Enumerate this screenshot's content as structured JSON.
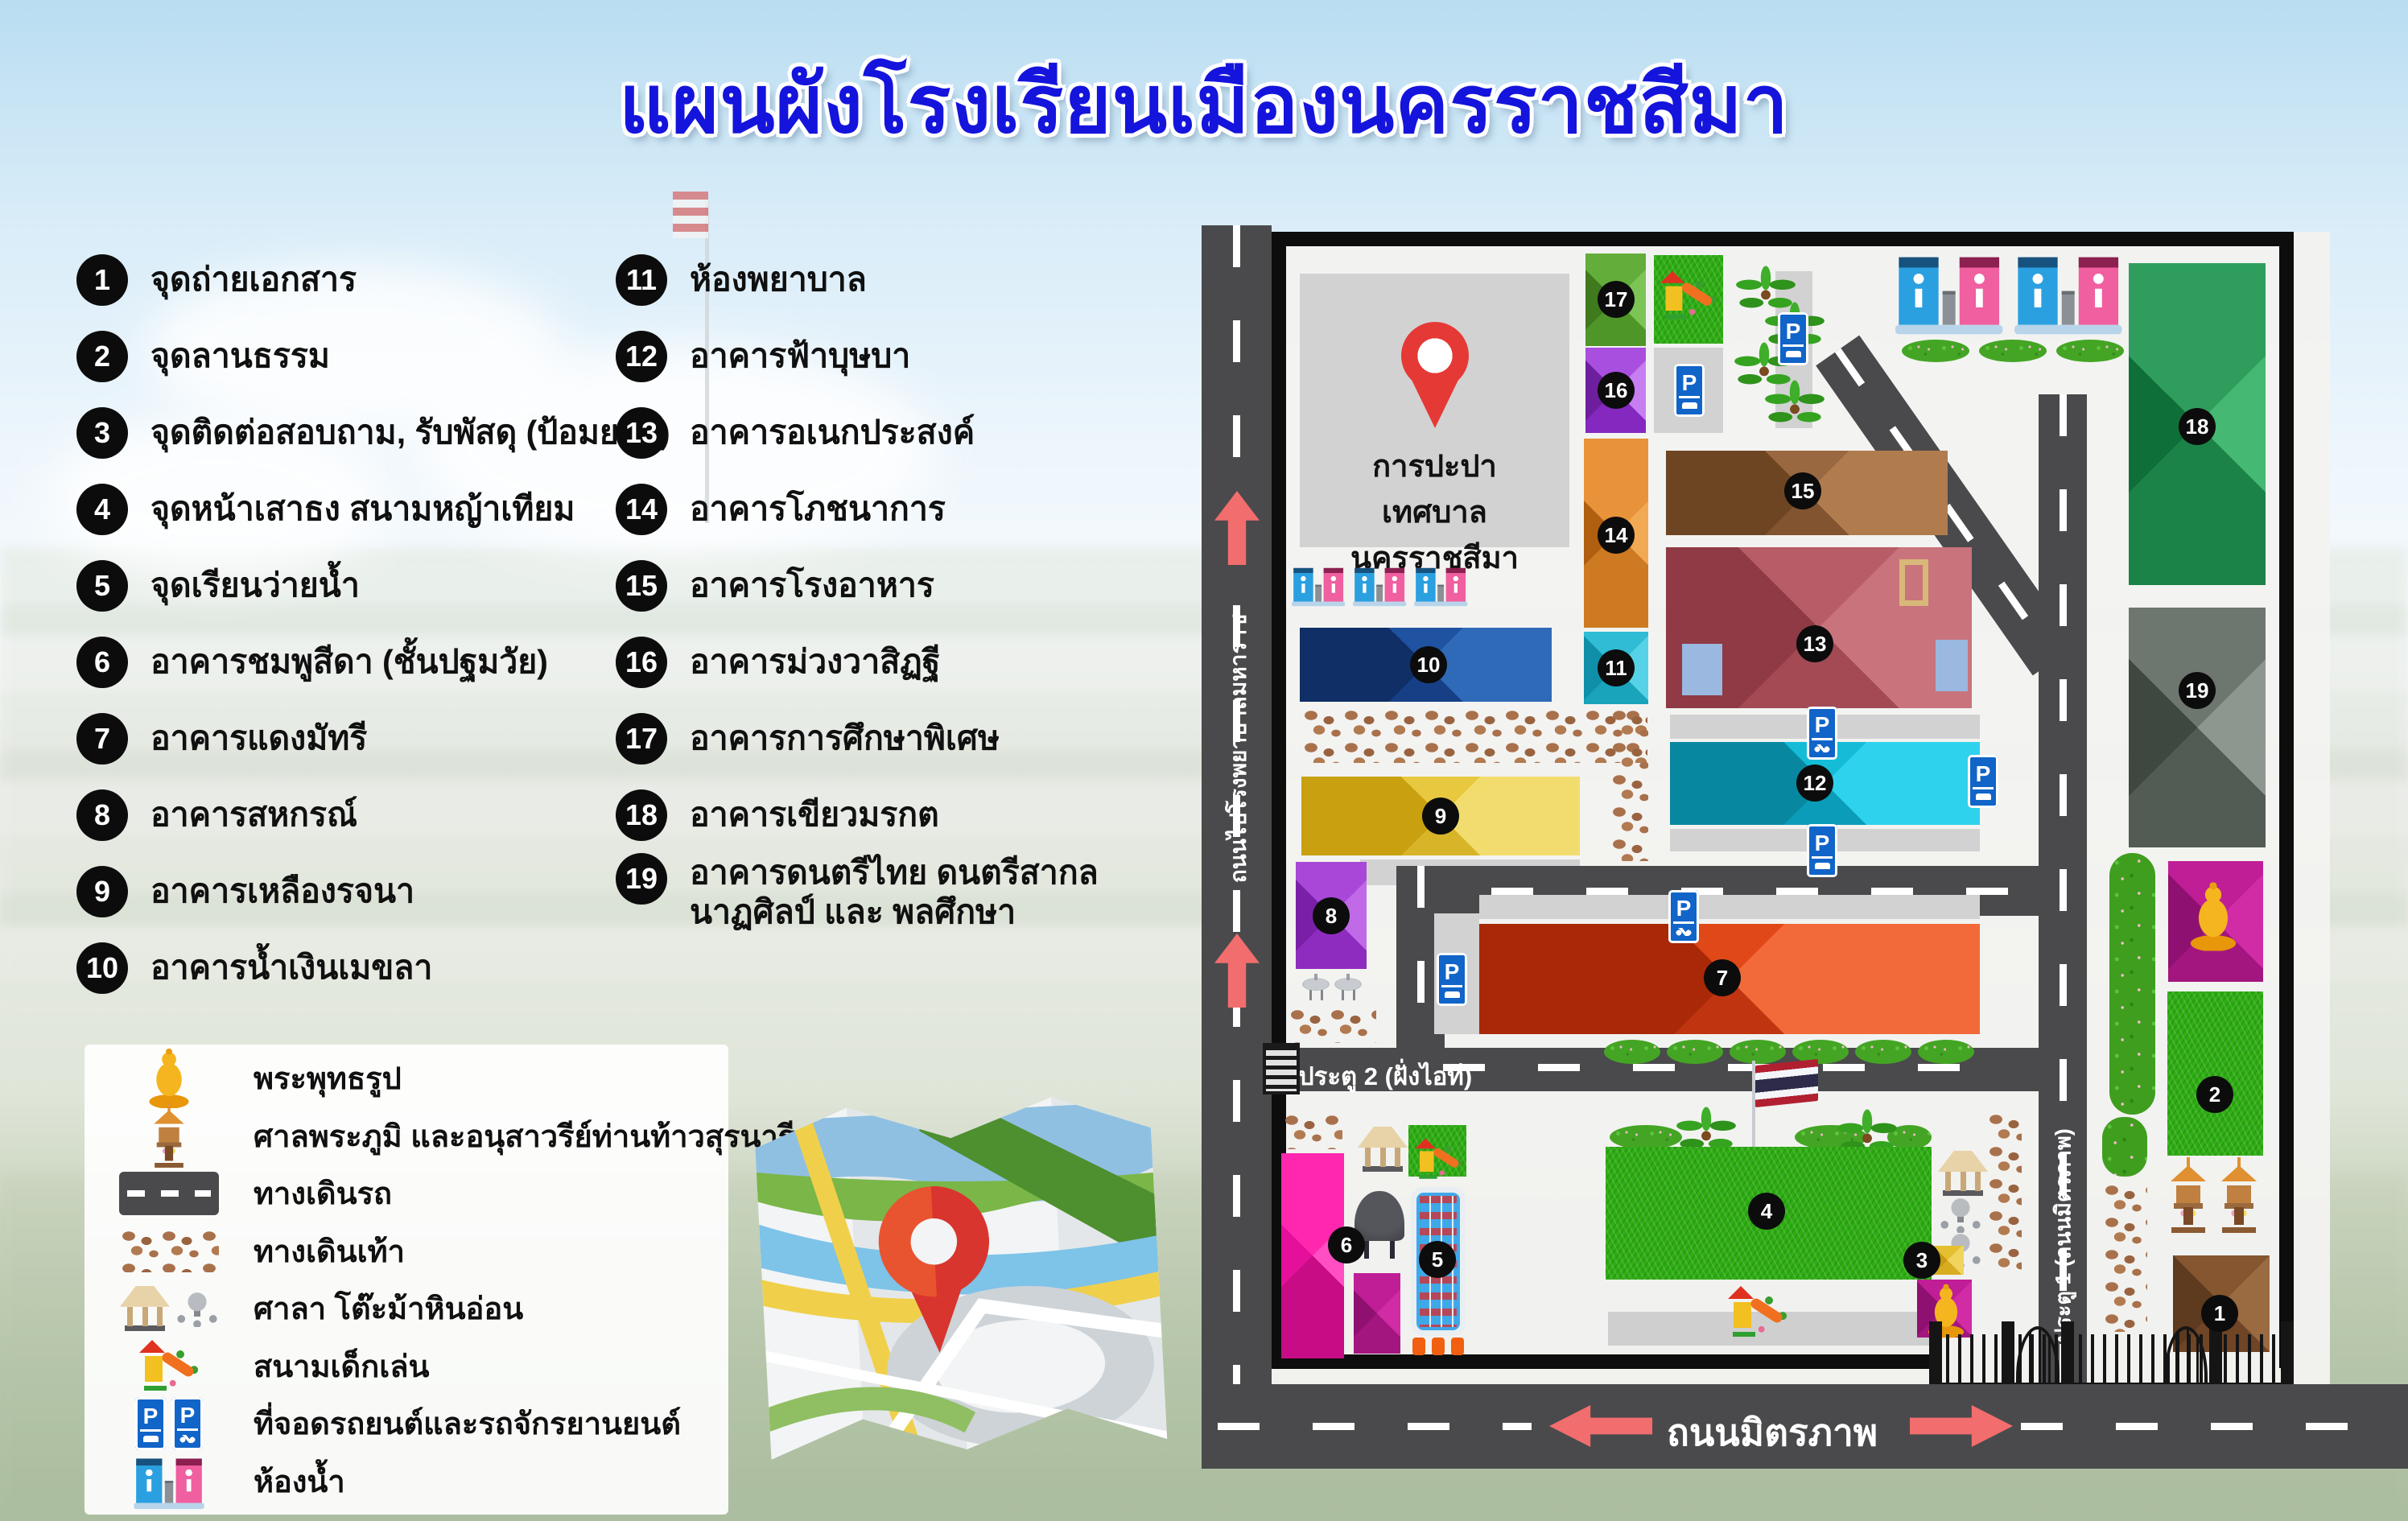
{
  "title": "แผนผังโรงเรียนเมืองนครราชสีมา",
  "legend": {
    "column1": [
      {
        "n": "1",
        "label": "จุดถ่ายเอกสาร"
      },
      {
        "n": "2",
        "label": "จุดลานธรรม"
      },
      {
        "n": "3",
        "label": "จุดติดต่อสอบถาม, รับพัสดุ (ป้อมยาม)"
      },
      {
        "n": "4",
        "label": "จุดหน้าเสาธง สนามหญ้าเทียม"
      },
      {
        "n": "5",
        "label": "จุดเรียนว่ายน้ำ"
      },
      {
        "n": "6",
        "label": "อาคารชมพูสีดา (ชั้นปฐมวัย)"
      },
      {
        "n": "7",
        "label": "อาคารแดงมัทรี"
      },
      {
        "n": "8",
        "label": "อาคารสหกรณ์"
      },
      {
        "n": "9",
        "label": "อาคารเหลืองรจนา"
      },
      {
        "n": "10",
        "label": "อาคารน้ำเงินเมขลา"
      }
    ],
    "column2": [
      {
        "n": "11",
        "label": "ห้องพยาบาล"
      },
      {
        "n": "12",
        "label": "อาคารฟ้าบุษบา"
      },
      {
        "n": "13",
        "label": "อาคารอเนกประสงค์"
      },
      {
        "n": "14",
        "label": "อาคารโภชนาการ"
      },
      {
        "n": "15",
        "label": "อาคารโรงอาหาร"
      },
      {
        "n": "16",
        "label": "อาคารม่วงวาสิฏฐี"
      },
      {
        "n": "17",
        "label": "อาคารการศึกษาพิเศษ"
      },
      {
        "n": "18",
        "label": "อาคารเขียวมรกต"
      },
      {
        "n": "19",
        "label": "อาคารดนตรีไทย ดนตรีสากล นาฏศิลป์ และ พลศึกษา"
      }
    ]
  },
  "icon_legend": [
    {
      "icon": "buddha-icon",
      "label": "พระพุทธรูป"
    },
    {
      "icon": "spirit-house-icon",
      "label": "ศาลพระภูมิ และอนุสาวรีย์ท่านท้าวสุรนารี"
    },
    {
      "icon": "road-icon",
      "label": "ทางเดินรถ"
    },
    {
      "icon": "footpath-icon",
      "label": "ทางเดินเท้า"
    },
    {
      "icon": "pavilion-icon",
      "label": "ศาลา โต๊ะม้าหินอ่อน"
    },
    {
      "icon": "playground-icon",
      "label": "สนามเด็กเล่น"
    },
    {
      "icon": "parking-icon",
      "label": "ที่จอดรถยนต์และรถจักรยานยนต์"
    },
    {
      "icon": "toilet-icon",
      "label": "ห้องน้ำ"
    }
  ],
  "map": {
    "waterworks": {
      "line1": "การปะปา",
      "line2": "เทศบาลนครราชสีมา"
    },
    "roads": {
      "left_road": "ถนนไปโรงพยาบาลมหาราช",
      "bottom_road": "ถนนมิตรภาพ",
      "gate2": "ประตู 2 (ฝั่งไอที)",
      "gate1": "ประตู 1 (ถนนมิตรภาพ)"
    },
    "badges": {
      "b1": "1",
      "b2": "2",
      "b3": "3",
      "b4": "4",
      "b5": "5",
      "b6": "6",
      "b7": "7",
      "b8": "8",
      "b9": "9",
      "b10": "10",
      "b11": "11",
      "b12": "12",
      "b13": "13",
      "b14": "14",
      "b15": "15",
      "b16": "16",
      "b17": "17",
      "b18": "18",
      "b19": "19"
    }
  },
  "colors": {
    "title_blue": "#1414dc",
    "road_gray": "#4a4a4c",
    "arrow_red": "#f26d6d",
    "parking_blue": "#1164c8",
    "grass_green": "#2fae14",
    "cobble_brown": "#a9714b",
    "bld7_red": "#e04818",
    "bld9_yellow": "#e8c83e",
    "bld10_navy": "#1f52a0",
    "bld12_cyan": "#14bcd8",
    "bld13_maroon": "#b85d68",
    "bld16_purple": "#a84fe0",
    "bld18_green": "#2f9e5c",
    "bld6_pink": "#ff27ae"
  }
}
